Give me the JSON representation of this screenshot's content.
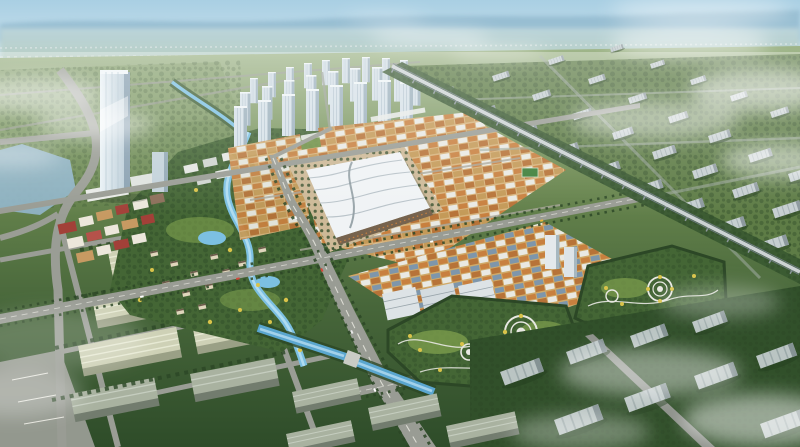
{
  "scene": {
    "type": "aerial-architectural-rendering",
    "description": "Bird's-eye master-plan rendering of a planned trade city: landmark glass tower, central eco-park with winding river and villa clusters, white residential high-rise cluster, wave-roofed exhibition hall surrounded by orange and blue roofed market blocks, two landscaped parks with circular plazas, elevated railway viaduct, rows of grey slab factory buildings in greenery, pale warehouse sheds to the west, hazy horizon with distant mountains, drifting clouds and fog",
    "visible_text": "none"
  },
  "palette": {
    "sky_top": "#a9cfe3",
    "sky_horizon": "#dcebf1",
    "mountains": "#93bacf",
    "haze_band_top": "#bdd6dc",
    "haze_band_bottom": "#b3c9b4",
    "ground_far": "#9fb589",
    "ground_mid1": "#6d8a51",
    "ground_mid2": "#47663a",
    "ground_near": "#2e4c29",
    "road": "#999c94",
    "road_dash": "#e6e6de",
    "water": "#5aa6cf",
    "water_light": "#aad6ec",
    "lake": "#8fb3c5",
    "warehouse_roof": "#ced1b6",
    "warehouse_side": "#9aa086",
    "shed_gray_roof": "#a9b2a0",
    "market_orange": "#c8803f",
    "market_orange_dark": "#b77338",
    "market_tan": "#d7b37c",
    "market_tan_dark": "#c49a58",
    "market_blue": "#7e96ab",
    "market_white": "#e9e9e3",
    "plaza": "#cdb997",
    "exhibition_roof": "#f0f3f5",
    "exhibition_facade": "#76634e",
    "tower_face": "#d6e1e8",
    "tower_shade": "#9db1bd",
    "landmark_light": "#eaf2f6",
    "landmark_dark": "#b2c6d2",
    "landmark_side": "#8ba2b2",
    "slab_face": "#c6cfd1",
    "slab_shade": "#8d999e",
    "park_green": "#446635",
    "lawn": "#7fa04e",
    "tree_dark": "#2c4726",
    "tree_yellow": "#d9c34a",
    "path_white": "#e8e8e2",
    "rail_deck": "#ccd2d4",
    "rail_corridor": "#3a5a32",
    "town_red": "#a24038",
    "town_white": "#ece7db",
    "town_tan": "#c79a62",
    "villa_wall": "#e0d6bc",
    "fog": "#ffffff"
  },
  "regions": [
    {
      "name": "sky",
      "desc": "hazy pale blue sky"
    },
    {
      "name": "distant-mountains",
      "desc": "soft blue mountain silhouette on horizon"
    },
    {
      "name": "distant-suburbs",
      "desc": "hazy low sprawl with white specks"
    },
    {
      "name": "landmark-tower",
      "desc": "tall glass landmark skyscraper with podium"
    },
    {
      "name": "central-eco-park",
      "desc": "green park, winding river, ponds, villa clusters"
    },
    {
      "name": "town-center",
      "desc": "colorful low-rise mixed-use strip"
    },
    {
      "name": "residential-highrises",
      "desc": "cluster of white residential towers"
    },
    {
      "name": "trade-market-north",
      "desc": "dense orange/white roofed trade blocks"
    },
    {
      "name": "exhibition-hall",
      "desc": "white wave-roofed convention center on plaza"
    },
    {
      "name": "trade-market-south",
      "desc": "orange/blue roofed market blocks"
    },
    {
      "name": "office-slabs",
      "desc": "mid-rise white commercial buildings"
    },
    {
      "name": "landscaped-park-west",
      "desc": "park with circular plazas and yellow trees"
    },
    {
      "name": "landscaped-park-east",
      "desc": "second park with circular plazas"
    },
    {
      "name": "elevated-railway",
      "desc": "rail viaduct crossing on green corridor"
    },
    {
      "name": "industrial-campus-east",
      "desc": "rows of grey slab buildings in greenery"
    },
    {
      "name": "warehouse-district-west",
      "desc": "large pale-roofed logistics sheds"
    },
    {
      "name": "grand-avenue",
      "desc": "wide tree-lined main boulevard"
    },
    {
      "name": "canal",
      "desc": "blue water channel with bridges"
    },
    {
      "name": "lake",
      "desc": "small lake by curved boulevard"
    },
    {
      "name": "clouds-and-fog",
      "desc": "white mist over left, right and lower-right"
    }
  ]
}
